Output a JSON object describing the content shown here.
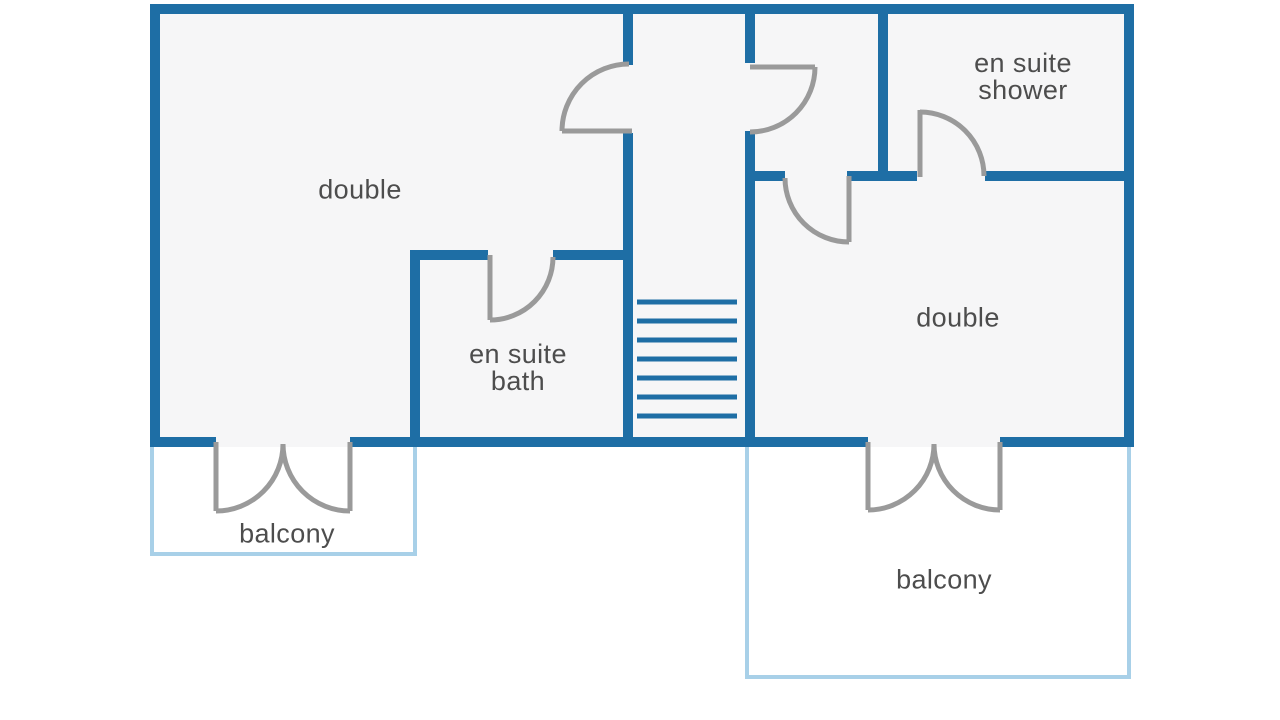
{
  "plan_type": "floor plan",
  "colors": {
    "wall": "#1e6ea5",
    "balcony_outline": "#a8d0e8",
    "door": "#9a9a9a",
    "label_text": "#4d4d4d",
    "floor": "#f6f6f7",
    "background": "#ffffff"
  },
  "rooms": {
    "double_left": {
      "label": "double"
    },
    "en_suite_bath": {
      "label_line1": "en suite",
      "label_line2": "bath"
    },
    "en_suite_shower": {
      "label_line1": "en suite",
      "label_line2": "shower"
    },
    "double_right": {
      "label": "double"
    },
    "balcony_left": {
      "label": "balcony"
    },
    "balcony_right": {
      "label": "balcony"
    }
  },
  "stairs": {
    "treads": 7
  },
  "doors": {
    "count": 7,
    "balcony_french_doors": 2
  }
}
